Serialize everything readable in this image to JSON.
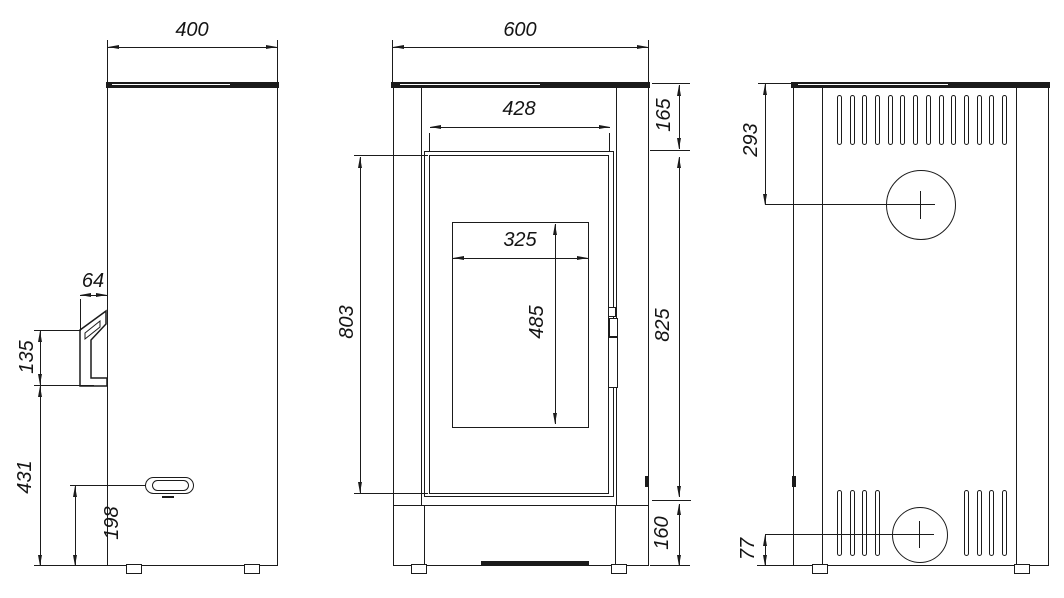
{
  "colors": {
    "line": "#1b1b1b",
    "background": "#ffffff"
  },
  "dimensions": {
    "side_depth": "400",
    "handle_offset": "64",
    "handle_length": "135",
    "handle_bottom_from_floor": "431",
    "latch_from_floor": "198",
    "front_width": "600",
    "door_width": "428",
    "top_band_height": "165",
    "glass_width": "325",
    "glass_height": "485",
    "door_height": "803",
    "door_band_height": "825",
    "base_height": "160",
    "flue_center_from_top": "293",
    "inlet_center_from_floor": "77"
  }
}
